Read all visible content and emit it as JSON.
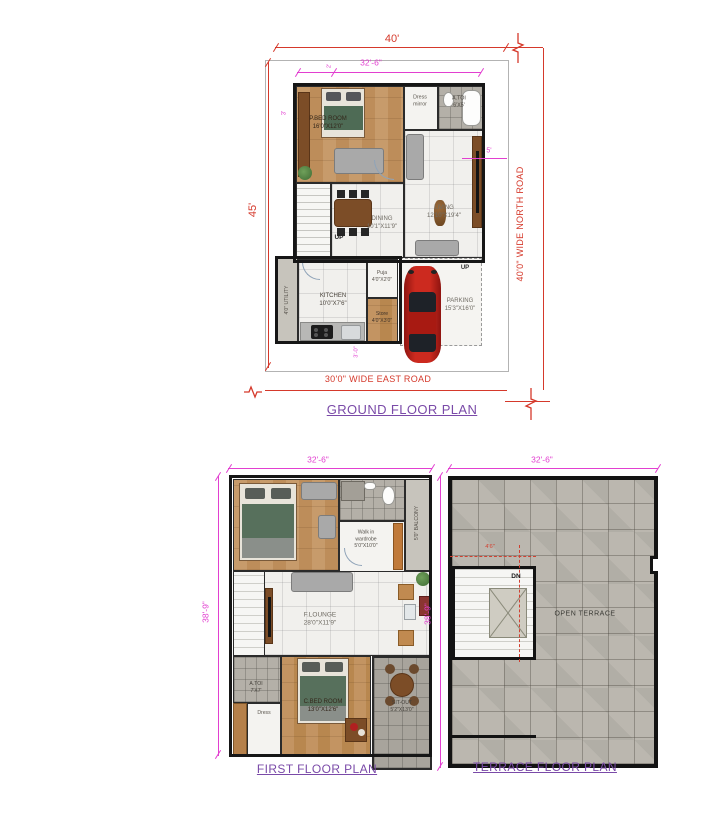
{
  "colors": {
    "dimension_red": "#d5392b",
    "dimension_magenta": "#e23fd0",
    "title_purple": "#7a4aa8",
    "wall_black": "#161616",
    "wood_floor": "#c0915f",
    "tile_gray": "#b4b0a8",
    "car_red": "#c0251c"
  },
  "ground_floor": {
    "title": "GROUND FLOOR PLAN",
    "dimensions": {
      "plot_width": "40'",
      "plot_depth": "45'",
      "building_width": "32'-6\"",
      "top_setback": "2'",
      "left_setback": "3'",
      "right_setback": "5'",
      "rear_setback": "3'-0\""
    },
    "roads": {
      "east": "30'0\" WIDE EAST ROAD",
      "north": "40'0\" WIDE NORTH ROAD"
    },
    "rooms": {
      "master_bedroom": {
        "name": "P.BED ROOM",
        "size": "16'0\"X12'0\""
      },
      "dress": {
        "name": "Dress",
        "size": "mirror"
      },
      "toilet": {
        "name": "A.TOI",
        "size": "6'X5'"
      },
      "living": {
        "name": "LIVING",
        "size": "12'10\"X19'4\""
      },
      "dining": {
        "name": "DINING",
        "size": "10'1\"X11'9\""
      },
      "kitchen": {
        "name": "KITCHEN",
        "size": "10'0\"X7'6\""
      },
      "utility": {
        "name": "4'0\" UTILITY"
      },
      "puja": {
        "name": "Puja",
        "size": "4'0\"X2'0\""
      },
      "store": {
        "name": "Store",
        "size": "4'0\"X3'0\""
      },
      "parking": {
        "name": "PARKING",
        "size": "15'3\"X16'0\""
      }
    },
    "stair_label": "UP",
    "entry_label": "UP"
  },
  "first_floor": {
    "title": "FIRST FLOOR PLAN",
    "dimensions": {
      "width": "32'-6\"",
      "depth": "38'-9\""
    },
    "rooms": {
      "wardrobe": {
        "line1": "Walk in",
        "line2": "wardrobe",
        "size": "5'0\"X10'0\""
      },
      "balcony": {
        "name": "5'0\" BALCONY"
      },
      "lounge": {
        "name": "F.LOUNGE",
        "size": "28'0\"X11'9\""
      },
      "toilet": {
        "name": "A.TOI",
        "size": "7'X7'"
      },
      "dress": {
        "name": "Dress"
      },
      "child_bedroom": {
        "name": "C.BED ROOM",
        "size": "13'0\"X12'6\""
      },
      "sitout": {
        "name": "SIT-OUT",
        "size": "5'2\"X13'0\""
      }
    }
  },
  "terrace_floor": {
    "title": "TERRACE FLOOR PLAN",
    "dimensions": {
      "width": "32'-6\"",
      "depth": "38'-9\"",
      "stair": "4'6\""
    },
    "labels": {
      "down": "DN",
      "open_terrace": "OPEN TERRACE"
    }
  }
}
